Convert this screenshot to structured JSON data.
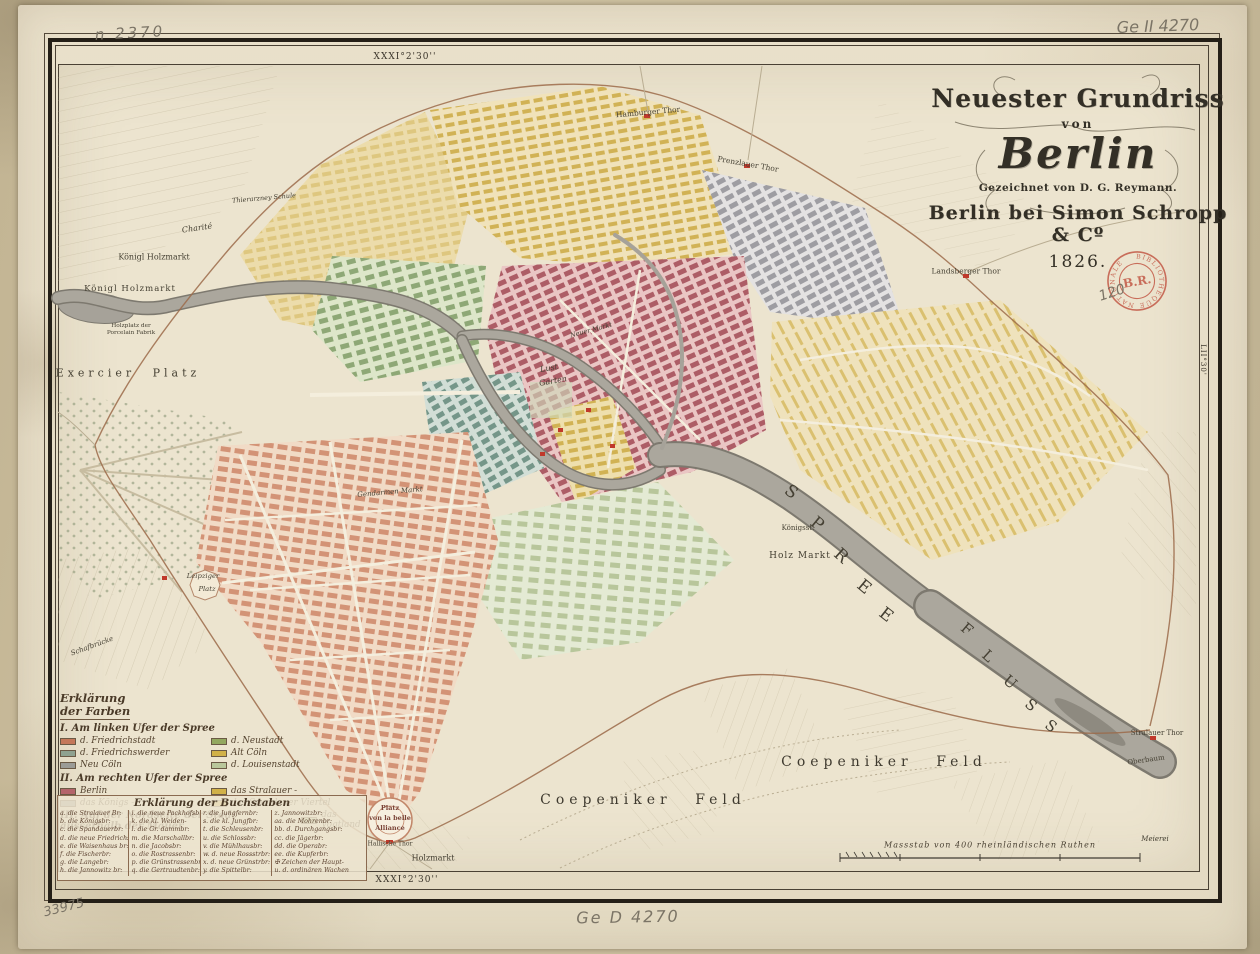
{
  "cartouche": {
    "line1": "Neuester Grundriss",
    "line2": "von",
    "line3": "Berlin",
    "line4": "Gezeichnet von D. G. Reymann.",
    "line5": "Berlin bei Simon Schropp & Cº",
    "line6": "1826."
  },
  "annotations": {
    "top_left": "n 2370",
    "top_right": "Ge II 4270",
    "near_stamp": "120",
    "bottom_center": "Ge D 4270",
    "bottom_left": "33975"
  },
  "stamp": {
    "ring_text": "BIBLIOTHEQUE NATIONALE",
    "center_text": "B.R.",
    "color": "#c0503e"
  },
  "border": {
    "meridian_top": "XXXI°2'30''",
    "meridian_bottom": "XXXI°2'30''",
    "latitude_right": "LII°30'"
  },
  "scale_bar": {
    "caption": "Massstab von 400 rheinländischen Ruthen"
  },
  "river": {
    "spree": [
      "S",
      "P",
      "R",
      "E",
      "E"
    ],
    "fluss": [
      "F",
      "L",
      "U",
      "S",
      "S"
    ]
  },
  "labels": {
    "charite": "Charité",
    "thierarznei": "Thierarzney Schule",
    "holzmarkt1": "Königl Holzmarkt",
    "holzmarkt2": "Königl Holzmarkt",
    "holzplatz": "Holzplatz der Porcelain Fabrik",
    "exercier": "Exercier Platz",
    "leipziger_1": "Leipziger",
    "leipziger_2": "Platz",
    "gendarmen": "Gendarmen Markt",
    "lustgarten_1": "Lust",
    "lustgarten_2": "Garten",
    "neuermarkt": "Neuer Markt",
    "hamburger": "Hamburger Thor",
    "prenzlauer": "Prenzlauer Thor",
    "landsberger": "Landsberger Thor",
    "koenigsstadt": "Königsst.",
    "holzmarkt_spree": "Holz Markt",
    "coepeniker": "Coepeniker Feld",
    "belle_1": "Platz",
    "belle_2": "von la belle",
    "belle_3": "Alliance",
    "hallische": "Hallische Thor",
    "holzmarkt_s": "Holzmarkt",
    "stralauer_thor": "Stralauer Thor",
    "oberbaum": "Oberbaum",
    "meierei": "Meierei",
    "schafbruecke": "Schafbrücke"
  },
  "legend_colors": {
    "title_line1": "Erklärung",
    "title_line2": "der Farben",
    "sections": [
      {
        "heading": "I. Am linken Ufer der Spree",
        "entries": [
          {
            "label": "d. Friedrichstadt",
            "color": "#c4785a"
          },
          {
            "label": "d. Neustadt",
            "color": "#93a85f"
          },
          {
            "label": "d. Friedrichswerder",
            "color": "#8fa290"
          },
          {
            "label": "Alt Cöln",
            "color": "#d1b148"
          },
          {
            "label": "Neu Cöln",
            "color": "#9b9b96"
          },
          {
            "label": "d. Louisenstadt",
            "color": "#b9c79b"
          }
        ]
      },
      {
        "heading": "II. Am rechten Ufer der Spree",
        "entries": [
          {
            "label": "Berlin",
            "color": "#b4656b"
          },
          {
            "label": "das Stralauer -",
            "color": "#d1b148"
          },
          {
            "label": "das Königs -",
            "color": "#9b9b96"
          },
          {
            "label": "das Spandauer Viertel",
            "color": "#d1b148"
          }
        ]
      },
      {
        "heading": "III. Auf der Nordseite der Stadt ausserhalb der Mauer",
        "entries": [
          {
            "label": "das Vogtland",
            "color": "#b9c79b"
          }
        ]
      }
    ]
  },
  "legend_letters": {
    "title": "Erklärung der Buchstaben",
    "columns": [
      [
        "a. die Stralauer Br:",
        "b. die Königsbr:",
        "c. die Spandauerbr:",
        "d. die neue Friedrichsbr:",
        "e. die Waisenhaus br:",
        "f. die Fischerbr:",
        "g. die Langebr:",
        "h. die Jannowitz br:"
      ],
      [
        "i. die neue Packhofsbr:",
        "k. die kl. Weiden-",
        "l. die Gr. dammbr:",
        "m. die Marschallbr:",
        "n. die Jacobsbr:",
        "o. die Rostrassenbr:",
        "p. die Grünstrassenbr:",
        "q. die Gertraudtenbr:"
      ],
      [
        "r. die Jungfernbr:",
        "s. die kl. Jungfbr:",
        "t. die Schleusenbr:",
        "u. die Schlossbr:",
        "v. die Mühlhausbr:",
        "w. d. neue Rossstrbr:",
        "x. d. neue Grünstrbr:",
        "y. die Spittelbr:"
      ],
      [
        "z. Jannowitzbr:",
        "aa. die Mohrenbr:",
        "bb. d. Durchgangsbr:",
        "cc. die Jägerbr:",
        "dd. die Operabr:",
        "ee. die Kupferbr:",
        "✠ Zeichen der Haupt-",
        "u. d. ordinären Wachen"
      ]
    ]
  }
}
